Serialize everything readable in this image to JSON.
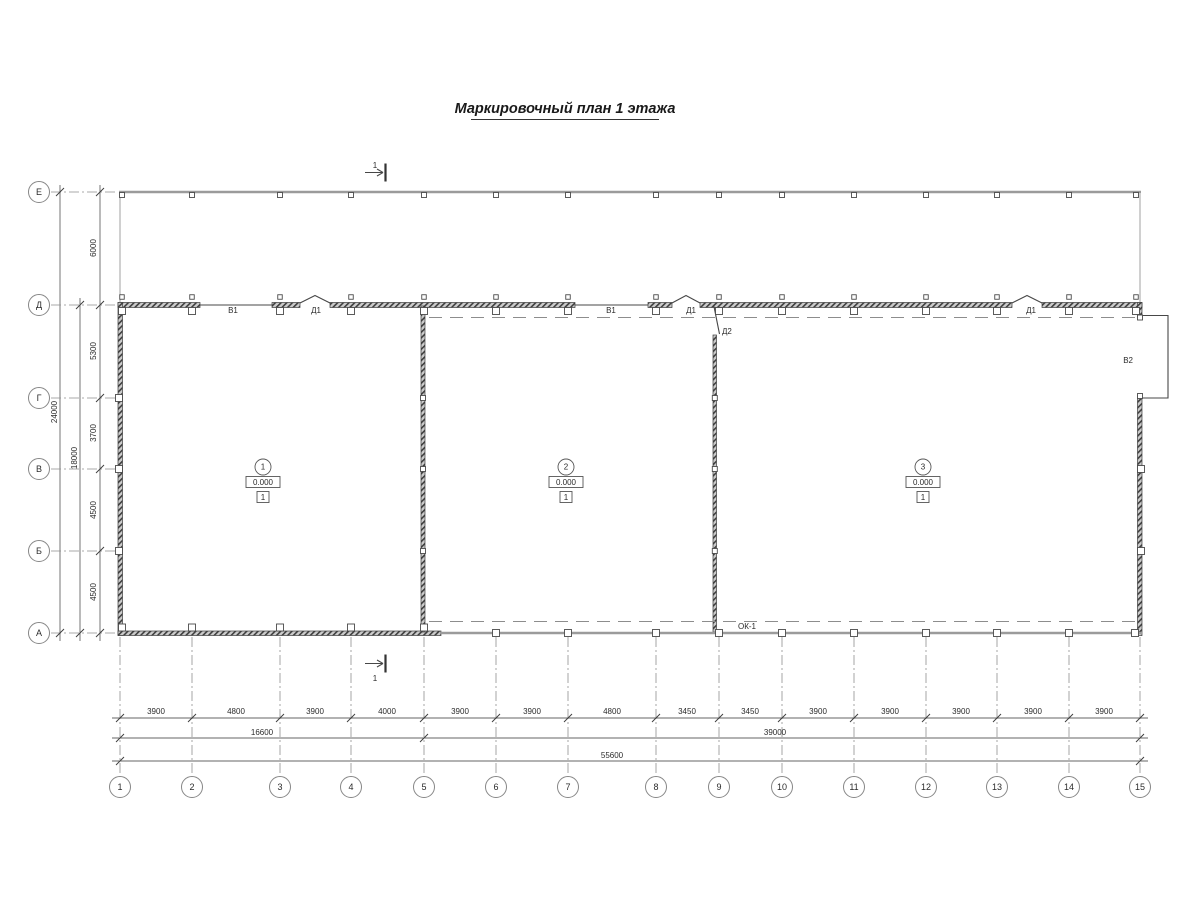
{
  "title": "Маркировочный план 1 этажа",
  "grid": {
    "rows": [
      "Е",
      "Д",
      "Г",
      "В",
      "Б",
      "А"
    ],
    "columns": [
      "1",
      "2",
      "3",
      "4",
      "5",
      "6",
      "7",
      "8",
      "9",
      "10",
      "11",
      "12",
      "13",
      "14",
      "15"
    ]
  },
  "dimensions": {
    "left": {
      "segments": [
        "6000",
        "5300",
        "3700",
        "4500",
        "4500"
      ],
      "totals": [
        "24000",
        "18000"
      ]
    },
    "bottom": {
      "segments": [
        "3900",
        "4800",
        "3900",
        "4000",
        "3900",
        "3900",
        "4800",
        "3450",
        "3450",
        "3900",
        "3900",
        "3900",
        "3900",
        "3900"
      ],
      "subtotals": [
        "16600",
        "39000"
      ],
      "total": "55600"
    }
  },
  "rooms": [
    {
      "number": "1",
      "elevation": "0.000",
      "floor_type": "1"
    },
    {
      "number": "2",
      "elevation": "0.000",
      "floor_type": "1"
    },
    {
      "number": "3",
      "elevation": "0.000",
      "floor_type": "1"
    }
  ],
  "openings": {
    "b1": "В1",
    "d1": "Д1",
    "d2": "Д2",
    "b2": "В2",
    "ok1": "ОК-1"
  },
  "section_marker": "1",
  "colors": {
    "ink": "#3d3d3d",
    "muted": "#9b9b9b",
    "background": "#ffffff"
  }
}
